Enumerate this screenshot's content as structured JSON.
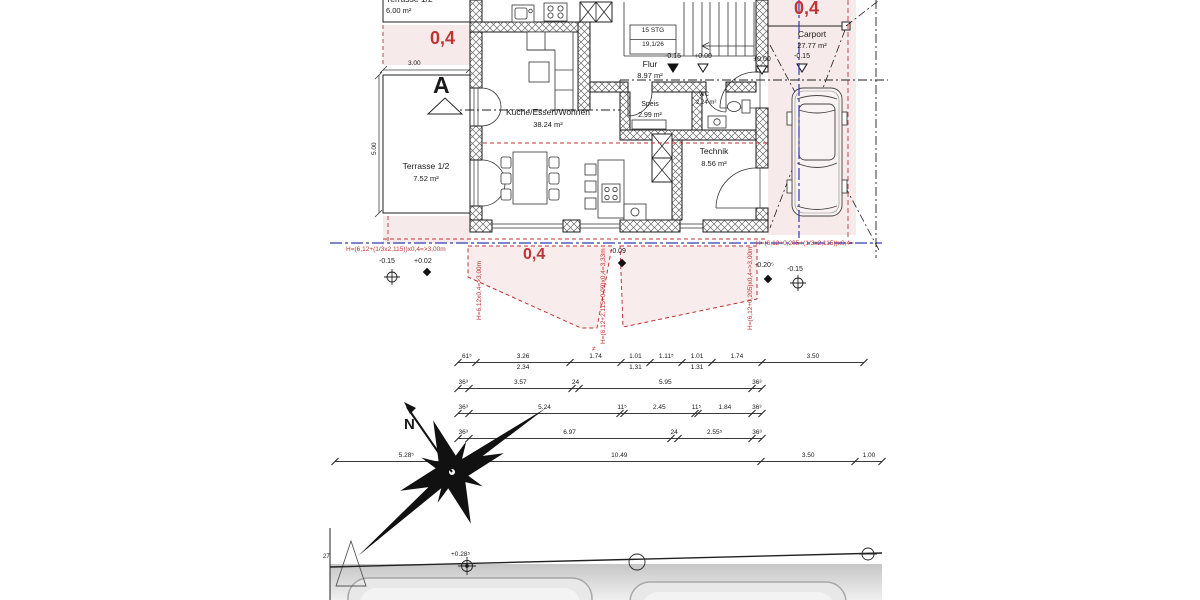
{
  "colors": {
    "accent_red": "#c23333",
    "pink_fill": "#f7eaea",
    "guide_blue": "#2d3cb5",
    "ink": "#1a1a1a"
  },
  "plan": {
    "section_marker": "A",
    "rooms": {
      "kitchen": {
        "name": "Küche/Essen/Wohnen",
        "area": "38.24 m²"
      },
      "flur": {
        "name": "Flur",
        "area": "8.97 m²"
      },
      "speis": {
        "name": "Speis",
        "area": "2.99 m²"
      },
      "wc": {
        "name": "WC",
        "area": "2.24 m²"
      },
      "technik": {
        "name": "Technik",
        "area": "8.56 m²"
      },
      "terrasse_top": {
        "name": "Terrasse 1/2",
        "area": "6.00 m²"
      },
      "terrasse_left": {
        "name": "Terrasse 1/2",
        "area": "7.52 m²"
      },
      "carport": {
        "name": "Carport",
        "area": "27.77 m²"
      }
    },
    "stairs": {
      "count": "15 STG",
      "ratio": "19,1/26"
    },
    "levels": {
      "hall_minus": "-0.15",
      "hall_zero": "+0.00",
      "entry_zero": "±0.00",
      "carport_minus": "-0.15"
    }
  },
  "site": {
    "height_formulas": {
      "left_h": "H=(6,12+(1/3x2,115))x0,4=>3,00m",
      "left_v": "H=6,12x0,4=>3,00m",
      "mid_v": "H=(6,12+2,115+0,09)x0,4=3,33m",
      "right_v": "H=(6,12+0,205)x0,4=>3,00m",
      "right_h": "H=(6,12+0,205+(1/3x2,115))x0,4="
    },
    "factors": {
      "band": "0,4",
      "zone": "0,4",
      "carport": "0,4"
    },
    "spot_levels": {
      "l1": "-0.15",
      "l2": "+0.02",
      "m1": "-0.09",
      "r1": "-0.20⁵",
      "r2": "-0.15",
      "street": "+0.28⁵"
    },
    "neq_mark": "≠",
    "parcel_number": "27",
    "north_label": "N"
  },
  "dimensions": {
    "terrace_width": "3.00",
    "terrace_height": "5.00",
    "rows": [
      {
        "y": 362,
        "x0": 458,
        "ppm": 29,
        "segments": [
          {
            "label": "61⁵",
            "m": 0.615
          },
          {
            "label": "3.26",
            "sub": "2.34",
            "m": 3.26
          },
          {
            "label": "1.74",
            "m": 1.74
          },
          {
            "label": "1.01",
            "sub": "1.31",
            "m": 1.01
          },
          {
            "label": "1.11⁵",
            "m": 1.115
          },
          {
            "label": "1.01",
            "sub": "1.31",
            "m": 1.01
          },
          {
            "label": "1.74",
            "m": 1.74
          },
          {
            "label": "3.50",
            "m": 3.5
          }
        ]
      },
      {
        "y": 388,
        "x0": 458,
        "ppm": 29,
        "segments": [
          {
            "label": "36³",
            "m": 0.363
          },
          {
            "label": "3.57",
            "m": 3.57
          },
          {
            "label": "24",
            "m": 0.24
          },
          {
            "label": "5.95",
            "m": 5.95
          },
          {
            "label": "36³",
            "m": 0.363
          }
        ]
      },
      {
        "y": 413,
        "x0": 458,
        "ppm": 29,
        "segments": [
          {
            "label": "36³",
            "m": 0.363
          },
          {
            "label": "5.24",
            "m": 5.24
          },
          {
            "label": "11⁵",
            "m": 0.115
          },
          {
            "label": "2.45",
            "m": 2.45
          },
          {
            "label": "11⁵",
            "m": 0.115
          },
          {
            "label": "1.84",
            "m": 1.84
          },
          {
            "label": "36³",
            "m": 0.363
          }
        ]
      },
      {
        "y": 438,
        "x0": 458,
        "ppm": 29,
        "segments": [
          {
            "label": "36³",
            "m": 0.363
          },
          {
            "label": "6.97",
            "m": 6.97
          },
          {
            "label": "24",
            "m": 0.24
          },
          {
            "label": "2.55⁵",
            "m": 2.555
          },
          {
            "label": "36³",
            "m": 0.363
          }
        ]
      },
      {
        "y": 461,
        "x0": 335,
        "ppm": 27,
        "segments": [
          {
            "label": "5.28⁵",
            "m": 5.285
          },
          {
            "label": "10.49",
            "m": 10.49
          },
          {
            "label": "3.50",
            "m": 3.5
          },
          {
            "label": "1.00",
            "m": 1.0
          }
        ]
      }
    ]
  }
}
